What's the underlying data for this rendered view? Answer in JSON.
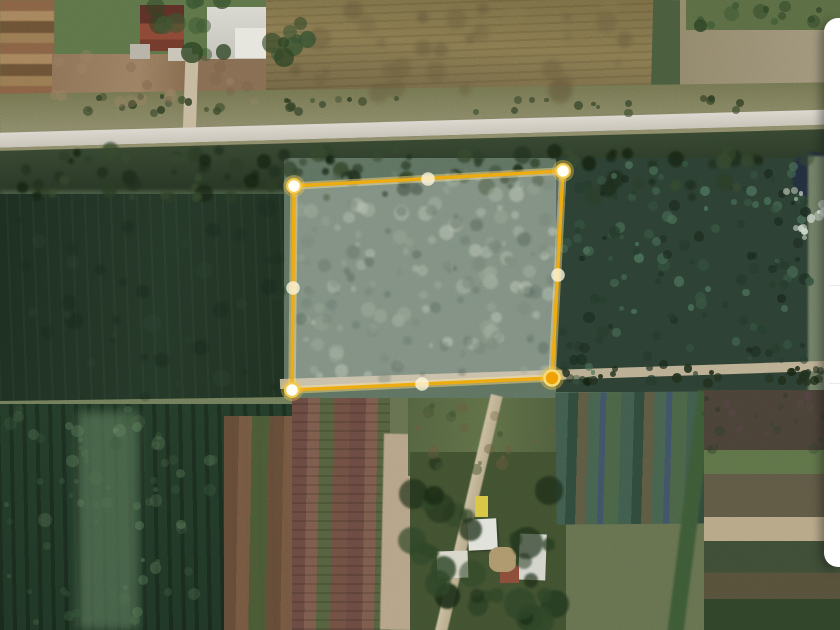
{
  "view": {
    "width_px": 840,
    "height_px": 630,
    "type": "satellite_imagery_with_parcel_overlay"
  },
  "parcel_overlay": {
    "stroke_color": "#EDAC12",
    "stroke_glow_color": "rgba(255,224,130,0.45)",
    "fill_color": "rgba(255,255,255,0.22)",
    "vertex_core_color": "#FFFEF4",
    "vertex_ring_color": "#F2C94C",
    "vertex_halo_color": "rgba(244,200,70,0.38)",
    "active_vertex_core_color": "#F0A106",
    "active_vertex_ring_color": "#F7DB74",
    "midpoint_color": "rgba(255,249,222,0.78)",
    "vertices": [
      {
        "x": 294,
        "y": 186,
        "state": "default"
      },
      {
        "x": 563,
        "y": 171,
        "state": "default"
      },
      {
        "x": 552,
        "y": 378,
        "state": "active"
      },
      {
        "x": 292,
        "y": 390,
        "state": "default"
      }
    ],
    "midpoints": [
      {
        "x": 428,
        "y": 179
      },
      {
        "x": 558,
        "y": 275
      },
      {
        "x": 422,
        "y": 384
      },
      {
        "x": 293,
        "y": 288
      }
    ]
  },
  "side_panel": {
    "background_color": "#FFFFFF",
    "divider_color": "#ECECEC",
    "visible_width_px": 16
  }
}
